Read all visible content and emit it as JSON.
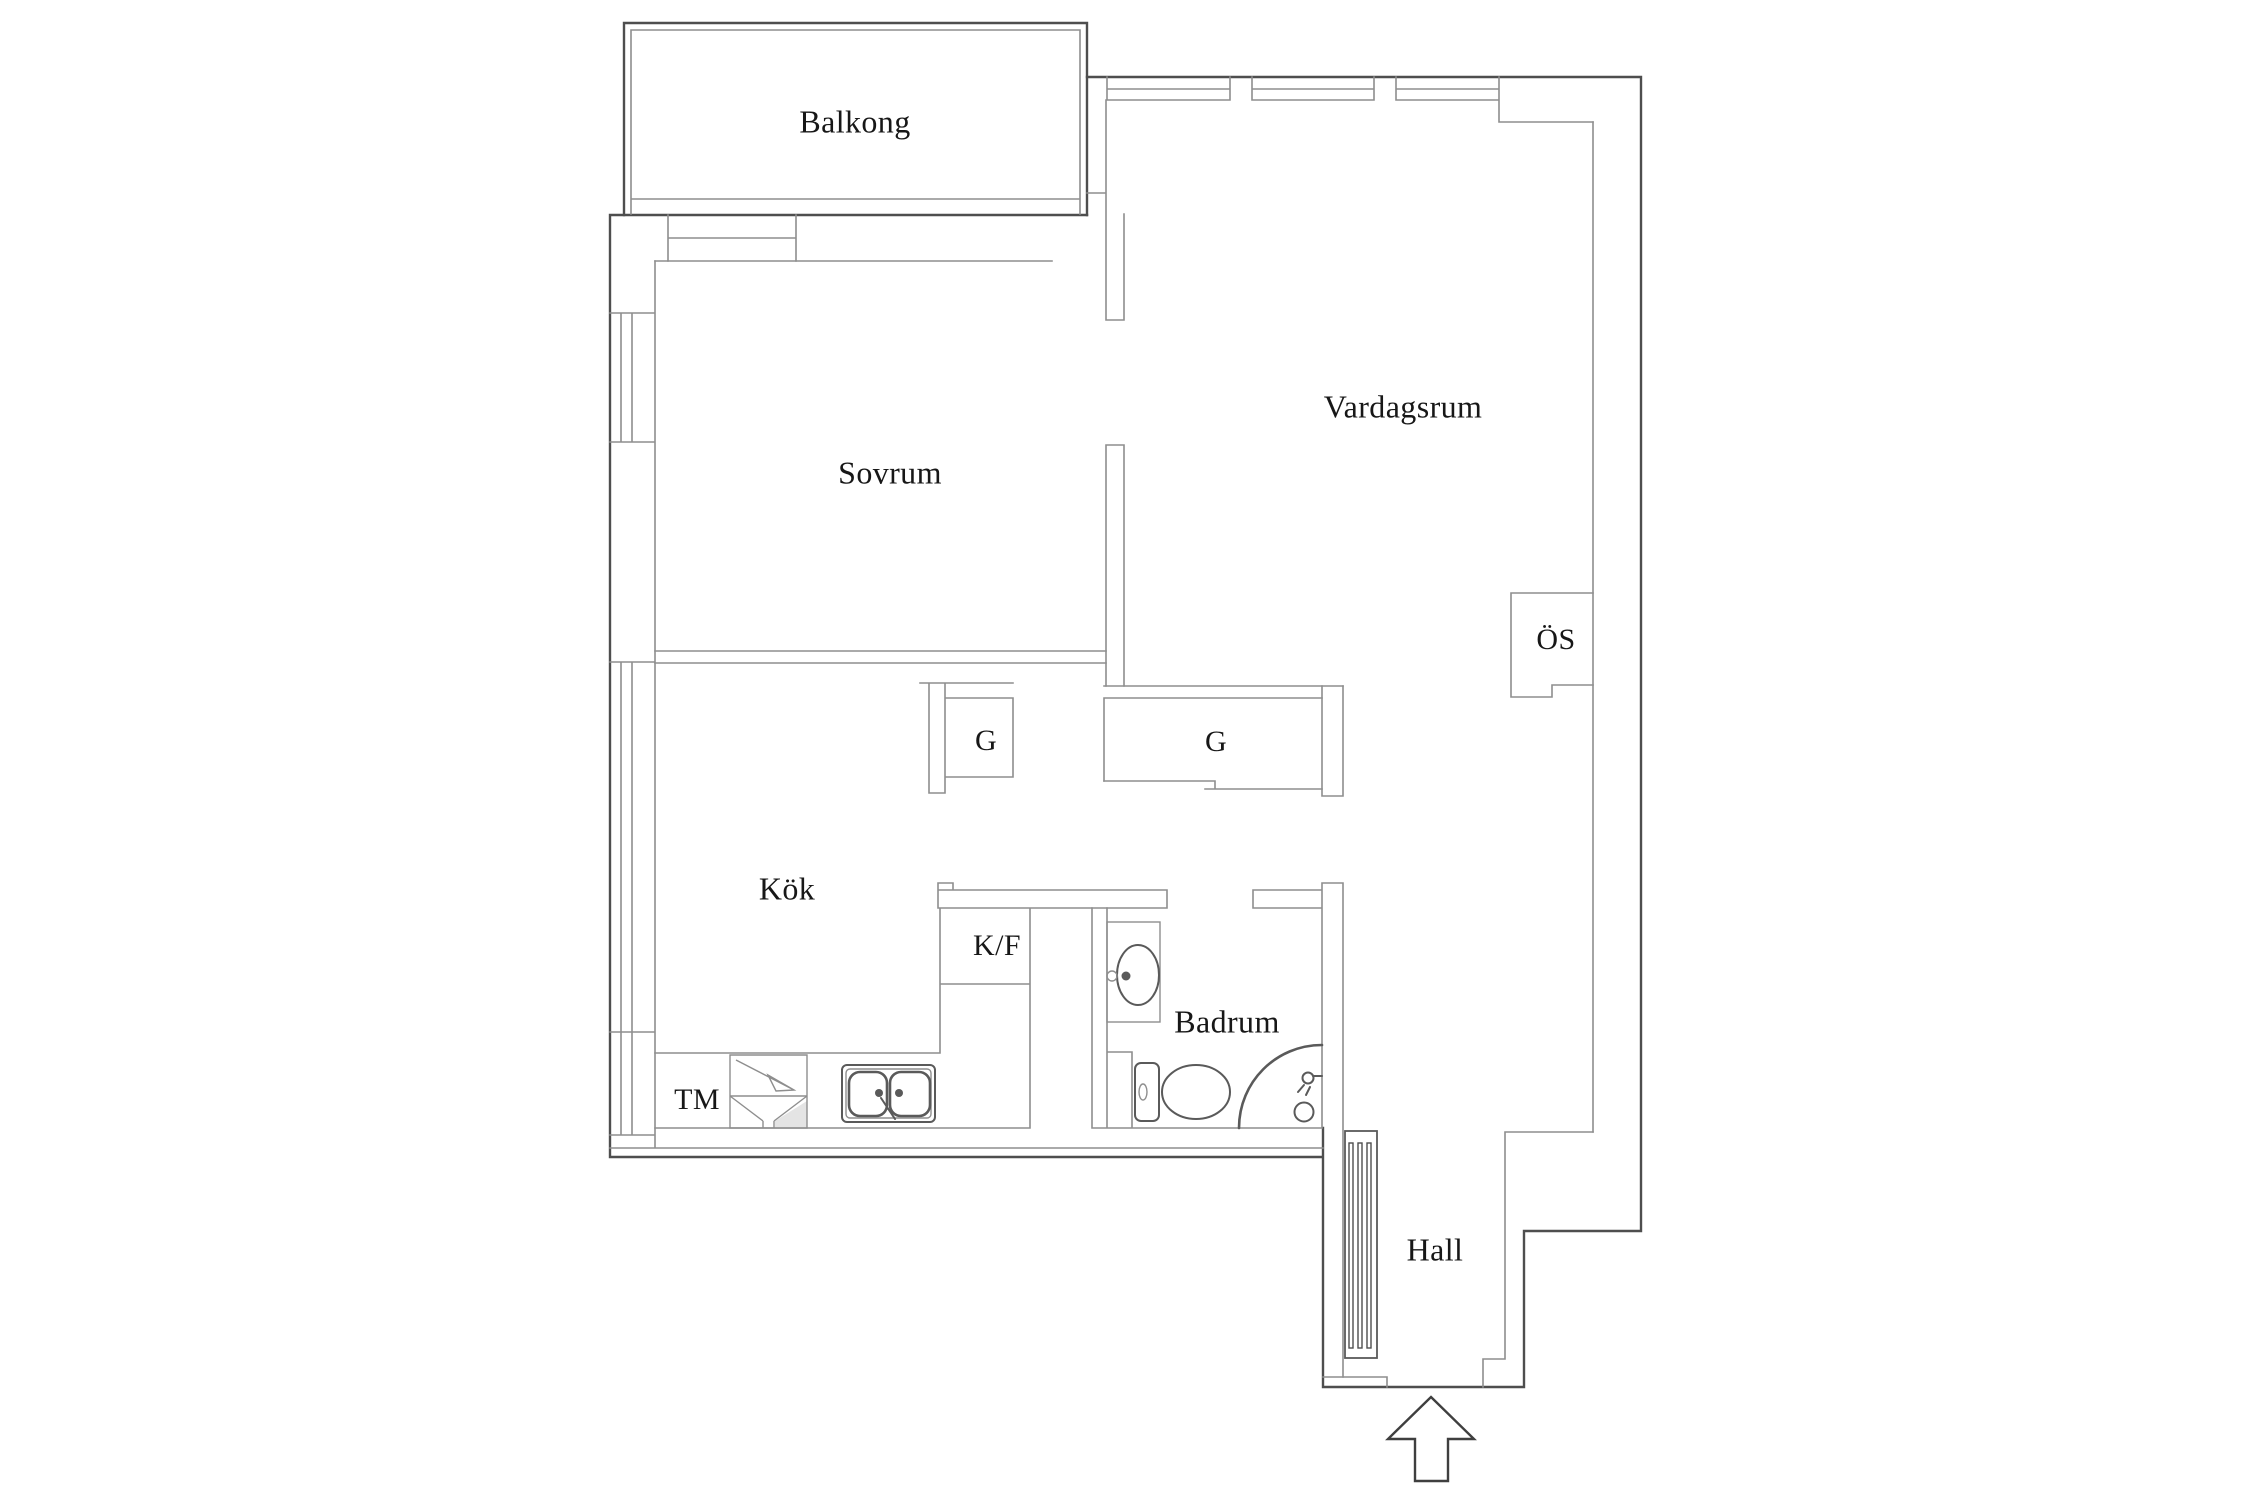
{
  "plan": {
    "type": "apartment-floor-plan",
    "rooms": {
      "balkong": {
        "label": "Balkong"
      },
      "sovrum": {
        "label": "Sovrum"
      },
      "vardagsrum": {
        "label": "Vardagsrum"
      },
      "kok": {
        "label": "Kök"
      },
      "badrum": {
        "label": "Badrum"
      },
      "hall": {
        "label": "Hall"
      }
    },
    "features": {
      "os_cabinet": {
        "label": "ÖS"
      },
      "closet_left": {
        "label": "G"
      },
      "closet_right": {
        "label": "G"
      },
      "fridge_freezer": {
        "label": "K/F"
      },
      "washing_machine": {
        "label": "TM"
      }
    },
    "icons": [
      "entrance-arrow-icon",
      "radiator-icon",
      "kitchen-sink-icon",
      "washing-machine-icon",
      "fridge-freezer-cabinet",
      "toilet-icon",
      "washbasin-icon",
      "shower-screen-arc",
      "shower-head-icon",
      "window-symbol",
      "sliding-closet-doors"
    ],
    "colors": {
      "bg": "#ffffff",
      "wall_dark": "#4e4e4e",
      "wall_light": "#8e8e8e",
      "text": "#171717",
      "shade": "#e4e4e4",
      "fixture": "#5a5a5a"
    }
  }
}
